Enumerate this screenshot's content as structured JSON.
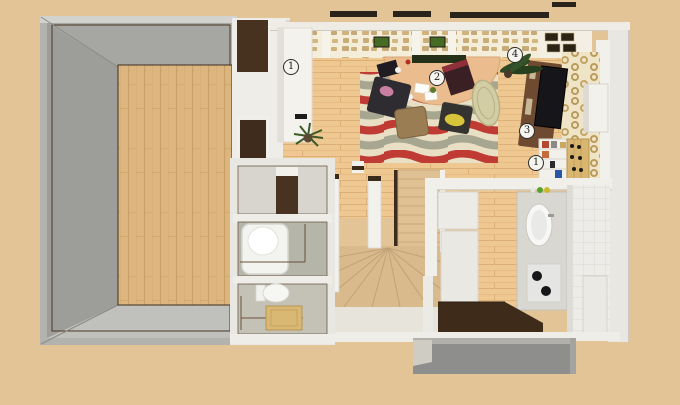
{
  "scene": {
    "type": "3d-floorplan-render",
    "floor": "first-floor-top-down-perspective"
  },
  "markers": [
    {
      "name": "marker-wardrobe",
      "label": "1",
      "x": 291,
      "y": 67
    },
    {
      "name": "marker-dining-table",
      "label": "2",
      "x": 437,
      "y": 78
    },
    {
      "name": "marker-wall-decor",
      "label": "4",
      "x": 515,
      "y": 55
    },
    {
      "name": "marker-tv-stand",
      "label": "3",
      "x": 527,
      "y": 131
    },
    {
      "name": "marker-bookshelf",
      "label": "1",
      "x": 536,
      "y": 163
    }
  ],
  "colors": {
    "background": "#e2c496",
    "wall_gray": "#b2b2ae",
    "wall_white": "#efede8",
    "wood_left_room": "#dcb67e",
    "wood_living": "#eec890",
    "rug_red": "#bf3b33",
    "rug_sage": "#a7a690",
    "rug_cream": "#e9dfc4",
    "stairs_tan": "#d9ba8d",
    "table_tan": "#ebbd8e",
    "tv_screen": "#15151a",
    "tv_stand_brown": "#6e4b30",
    "entrance_mat_brown": "#3e2b1a",
    "porch_gray": "#8e8e8c",
    "marker_background": "#f6f4ee",
    "marker_border": "#2b2b2b"
  }
}
